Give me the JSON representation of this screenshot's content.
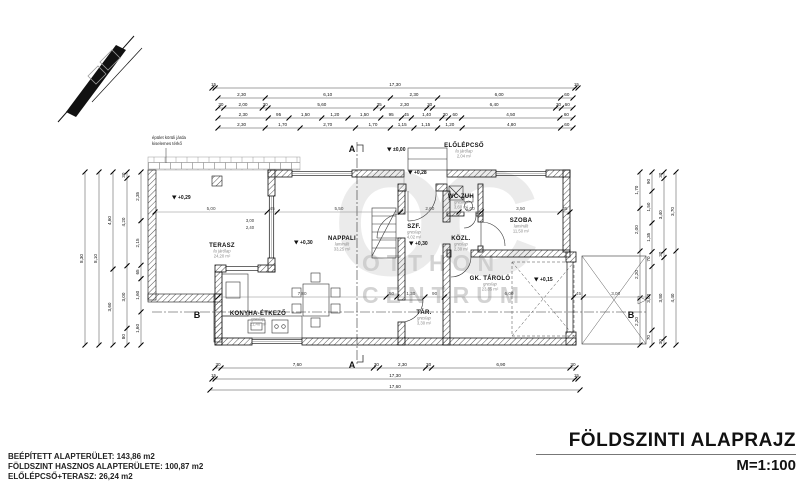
{
  "title": {
    "main": "FÖLDSZINTI ALAPRAJZ",
    "scale": "M=1:100"
  },
  "summary": {
    "line1": "BEÉPÍTETT ALAPTERÜLET: 143,86 m2",
    "line2": "FÖLDSZINT HASZNOS ALAPTERÜLETE: 100,87 m2",
    "line3": "ELŐLÉPCSŐ+TERASZ: 26,24 m2"
  },
  "watermark": {
    "monogram": "OC",
    "line1": "OTTHON",
    "line2": "CENTRUM"
  },
  "note": {
    "line1": "épület körüli járda",
    "line2": "kiselemes térkő",
    "x": 152,
    "y": 139
  },
  "colors": {
    "line": "#111111",
    "muted": "#8a8a8a",
    "watermark": "#c9c9c9"
  },
  "plan": {
    "rooms": [
      {
        "name": "TERASZ",
        "material": "fa járólap",
        "area": "24,20 m²",
        "x": 222,
        "y": 247
      },
      {
        "name": "NAPPALI",
        "material": "laminált",
        "area": "33,25 m²",
        "x": 342,
        "y": 240
      },
      {
        "name": "KONYHA-ÉTKEZŐ",
        "material": "greslap",
        "area": "21,40 m²",
        "x": 258,
        "y": 315
      },
      {
        "name": "SZF.",
        "material": "greslap",
        "area": "4,02 m²",
        "x": 414,
        "y": 228
      },
      {
        "name": "WC-ZUH",
        "material": "greslap",
        "area": "3,60 m²",
        "x": 461,
        "y": 198
      },
      {
        "name": "KÖZL.",
        "material": "greslap",
        "area": "2,30 m²",
        "x": 461,
        "y": 240
      },
      {
        "name": "SZOBA",
        "material": "laminált",
        "area": "11,50 m²",
        "x": 521,
        "y": 222
      },
      {
        "name": "GK. TÁROLÓ",
        "material": "greslap",
        "area": "23,85 m²",
        "x": 490,
        "y": 280
      },
      {
        "name": "TÁR.",
        "material": "greslap",
        "area": "3,30 m²",
        "x": 424,
        "y": 314
      },
      {
        "name": "ELŐLÉPCSŐ",
        "material": "fa járólap",
        "area": "2,04 m²",
        "x": 464,
        "y": 147
      }
    ],
    "levels": [
      {
        "label": "±0,00",
        "x": 393,
        "y": 151
      },
      {
        "label": "+0,28",
        "x": 414,
        "y": 174
      },
      {
        "label": "+0,30",
        "x": 300,
        "y": 244
      },
      {
        "label": "+0,30",
        "x": 415,
        "y": 245
      },
      {
        "label": "+0,29",
        "x": 178,
        "y": 199
      },
      {
        "label": "+0,15",
        "x": 540,
        "y": 281
      }
    ],
    "sections": [
      {
        "label": "A",
        "x": 352,
        "y": 152
      },
      {
        "label": "A",
        "x": 352,
        "y": 368
      },
      {
        "label": "B",
        "x": 197,
        "y": 318
      },
      {
        "label": "B",
        "x": 631,
        "y": 318
      }
    ],
    "annotations": [
      {
        "text": "3,00",
        "x": 250,
        "y": 222
      },
      {
        "text": "2,40",
        "x": 250,
        "y": 229
      }
    ],
    "dim_chains": [
      {
        "id": "top-1",
        "axis": "h",
        "y": 88,
        "x1": 212,
        "x2": 578,
        "labels": [
          "15",
          "17,30",
          "15"
        ]
      },
      {
        "id": "top-2",
        "axis": "h",
        "y": 98,
        "x1": 218,
        "x2": 573,
        "labels": [
          "2,30",
          "6,10",
          "2,30",
          "6,00",
          "60"
        ]
      },
      {
        "id": "top-3",
        "axis": "h",
        "y": 108,
        "x1": 218,
        "x2": 573,
        "labels": [
          "30",
          "2,00",
          "30",
          "5,60",
          "35",
          "2,30",
          "30",
          "6,40",
          "30",
          "60"
        ]
      },
      {
        "id": "top-4",
        "axis": "h",
        "y": 118,
        "x1": 218,
        "x2": 573,
        "labels": [
          "2,30",
          "95",
          "1,50",
          "1,20",
          "1,50",
          "95",
          "45",
          "1,40",
          "30",
          "60",
          "4,50",
          "60"
        ]
      },
      {
        "id": "top-5",
        "axis": "h",
        "y": 128,
        "x1": 218,
        "x2": 573,
        "labels": [
          "2,30",
          "1,70",
          "2,70",
          "1,70",
          "1,15",
          "1,15",
          "1,20",
          "4,80",
          "60"
        ]
      },
      {
        "id": "bottom-1",
        "axis": "h",
        "y": 368,
        "x1": 215,
        "x2": 576,
        "labels": [
          "30",
          "7,60",
          "30",
          "2,30",
          "30",
          "6,90",
          "30"
        ]
      },
      {
        "id": "bottom-2",
        "axis": "h",
        "y": 379,
        "x1": 212,
        "x2": 578,
        "labels": [
          "15",
          "17,30",
          "15"
        ]
      },
      {
        "id": "bottom-3",
        "axis": "h",
        "y": 390,
        "x1": 210,
        "x2": 580,
        "labels": [
          "17,60"
        ]
      },
      {
        "id": "left-1",
        "axis": "v",
        "x": 85,
        "y1": 172,
        "y2": 345,
        "labels": [
          "8,30"
        ]
      },
      {
        "id": "left-2",
        "axis": "v",
        "x": 99,
        "y1": 172,
        "y2": 345,
        "labels": [
          "8,10"
        ]
      },
      {
        "id": "left-3",
        "axis": "v",
        "x": 113,
        "y1": 172,
        "y2": 345,
        "labels": [
          "4,60",
          "3,60"
        ]
      },
      {
        "id": "left-4",
        "axis": "v",
        "x": 127,
        "y1": 172,
        "y2": 345,
        "labels": [
          "30",
          "4,20",
          "3,00",
          "80"
        ]
      },
      {
        "id": "left-5",
        "axis": "v",
        "x": 141,
        "y1": 172,
        "y2": 345,
        "labels": [
          "2,35",
          "2,15",
          "65",
          "1,60",
          "1,60"
        ]
      },
      {
        "id": "right-1",
        "axis": "v",
        "x": 640,
        "y1": 172,
        "y2": 345,
        "labels": [
          "1,70",
          "2,00",
          "2,20",
          "2,20"
        ]
      },
      {
        "id": "right-2",
        "axis": "v",
        "x": 652,
        "y1": 172,
        "y2": 345,
        "labels": [
          "90",
          "1,50",
          "1,35",
          "70",
          "3,00",
          "70"
        ]
      },
      {
        "id": "right-3",
        "axis": "v",
        "x": 664,
        "y1": 172,
        "y2": 345,
        "labels": [
          "30",
          "3,40",
          "30",
          "3,80",
          "30"
        ]
      },
      {
        "id": "right-4",
        "axis": "v",
        "x": 676,
        "y1": 172,
        "y2": 345,
        "labels": [
          "3,70",
          "4,40"
        ]
      },
      {
        "id": "inner-1",
        "axis": "h",
        "y": 212,
        "x1": 155,
        "x2": 570,
        "light": true,
        "labels": [
          "5,00",
          "45",
          "5,50",
          "2,60",
          "1,00",
          "3,50",
          "45"
        ]
      },
      {
        "id": "inner-2",
        "axis": "h",
        "y": 297,
        "x1": 218,
        "x2": 648,
        "light": true,
        "labels": [
          "7,80",
          "50",
          "1,30",
          "90",
          "6,00",
          "45",
          "3,00"
        ]
      }
    ]
  }
}
